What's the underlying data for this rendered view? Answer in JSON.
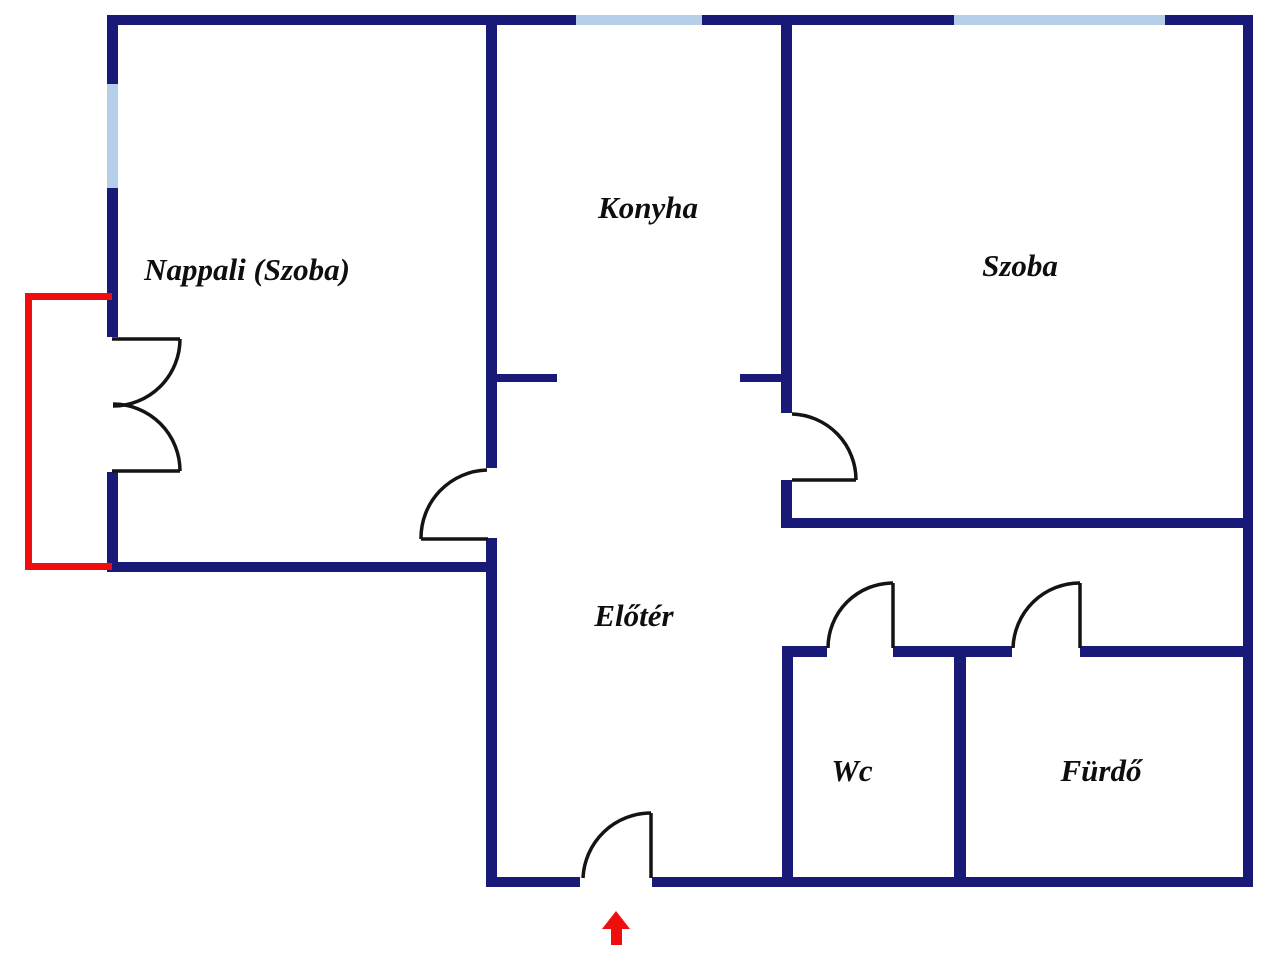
{
  "title": "Apartment floor plan",
  "canvas": {
    "width": 1280,
    "height": 960
  },
  "colors": {
    "wall": "#191977",
    "window": "#b6cfe9",
    "balcony": "#ee0e0e",
    "door": "#141414",
    "arrow": "#ee0e0e",
    "background": "#ffffff",
    "label": "#0e0e0e"
  },
  "rooms": [
    {
      "id": "nappali",
      "label": "Nappali (Szoba)",
      "cx": 247,
      "cy": 270
    },
    {
      "id": "konyha",
      "label": "Konyha",
      "cx": 648,
      "cy": 208
    },
    {
      "id": "szoba",
      "label": "Szoba",
      "cx": 1020,
      "cy": 266
    },
    {
      "id": "eloter",
      "label": "Előtér",
      "cx": 634,
      "cy": 616
    },
    {
      "id": "wc",
      "label": "Wc",
      "cx": 852,
      "cy": 771
    },
    {
      "id": "furdo",
      "label": "Fürdő",
      "cx": 1101,
      "cy": 771
    }
  ],
  "structure": {
    "walls": [
      {
        "name": "top-wall-a",
        "x": 107,
        "y": 15,
        "w": 469,
        "h": 10
      },
      {
        "name": "top-wall-b",
        "x": 702,
        "y": 15,
        "w": 252,
        "h": 10
      },
      {
        "name": "top-wall-c",
        "x": 1165,
        "y": 15,
        "w": 88,
        "h": 10
      },
      {
        "name": "left-wall-a",
        "x": 107,
        "y": 15,
        "w": 11,
        "h": 69
      },
      {
        "name": "left-wall-b",
        "x": 107,
        "y": 188,
        "w": 11,
        "h": 149
      },
      {
        "name": "left-wall-c",
        "x": 107,
        "y": 472,
        "w": 11,
        "h": 94
      },
      {
        "name": "nappali-bottom-wall",
        "x": 107,
        "y": 562,
        "w": 390,
        "h": 10
      },
      {
        "name": "center-wall-a",
        "x": 486,
        "y": 15,
        "w": 11,
        "h": 453
      },
      {
        "name": "center-wall-b",
        "x": 486,
        "y": 538,
        "w": 11,
        "h": 349
      },
      {
        "name": "konyha-stub-left",
        "x": 497,
        "y": 374,
        "w": 60,
        "h": 8
      },
      {
        "name": "konyha-stub-right",
        "x": 740,
        "y": 374,
        "w": 42,
        "h": 8
      },
      {
        "name": "konyha-szoba-wall-a",
        "x": 781,
        "y": 15,
        "w": 11,
        "h": 398
      },
      {
        "name": "konyha-szoba-wall-b",
        "x": 781,
        "y": 480,
        "w": 11,
        "h": 48
      },
      {
        "name": "szoba-bottom-wall",
        "x": 781,
        "y": 518,
        "w": 472,
        "h": 10
      },
      {
        "name": "right-wall",
        "x": 1243,
        "y": 15,
        "w": 10,
        "h": 872
      },
      {
        "name": "bottom-wall-a",
        "x": 486,
        "y": 877,
        "w": 94,
        "h": 10
      },
      {
        "name": "bottom-wall-b",
        "x": 652,
        "y": 877,
        "w": 601,
        "h": 10
      },
      {
        "name": "wc-left-wall",
        "x": 782,
        "y": 646,
        "w": 11,
        "h": 241
      },
      {
        "name": "bath-top-wall-a",
        "x": 782,
        "y": 646,
        "w": 45,
        "h": 11
      },
      {
        "name": "bath-top-wall-b",
        "x": 893,
        "y": 646,
        "w": 119,
        "h": 11
      },
      {
        "name": "bath-top-wall-c",
        "x": 1080,
        "y": 646,
        "w": 173,
        "h": 11
      },
      {
        "name": "wc-furdo-divider",
        "x": 954,
        "y": 657,
        "w": 12,
        "h": 230
      }
    ],
    "windows": [
      {
        "name": "window-konyha-top",
        "x": 576,
        "y": 15,
        "w": 126,
        "h": 10
      },
      {
        "name": "window-szoba-top",
        "x": 954,
        "y": 15,
        "w": 211,
        "h": 10
      },
      {
        "name": "window-nappali-left",
        "x": 107,
        "y": 84,
        "w": 11,
        "h": 104
      }
    ],
    "balcony": [
      {
        "name": "balcony-top",
        "x": 25,
        "y": 293,
        "w": 87,
        "h": 7
      },
      {
        "name": "balcony-left",
        "x": 25,
        "y": 293,
        "w": 7,
        "h": 277
      },
      {
        "name": "balcony-bottom",
        "x": 25,
        "y": 563,
        "w": 87,
        "h": 7
      }
    ],
    "doors": [
      {
        "name": "balcony-door-upper",
        "leaf": [
          112,
          339,
          180,
          339
        ],
        "arc_from": [
          180,
          339
        ],
        "arc_to": [
          113,
          406
        ],
        "r": 67,
        "sweep": 1
      },
      {
        "name": "balcony-door-lower",
        "leaf": [
          112,
          471,
          180,
          471
        ],
        "arc_from": [
          180,
          471
        ],
        "arc_to": [
          113,
          404
        ],
        "r": 67,
        "sweep": 0
      },
      {
        "name": "nappali-door",
        "leaf": [
          421,
          539,
          488,
          539
        ],
        "arc_from": [
          421,
          539
        ],
        "arc_to": [
          487,
          470
        ],
        "r": 68,
        "sweep": 1
      },
      {
        "name": "szoba-door",
        "leaf": [
          792,
          480,
          856,
          480
        ],
        "arc_from": [
          792,
          414
        ],
        "arc_to": [
          856,
          480
        ],
        "r": 66,
        "sweep": 1
      },
      {
        "name": "wc-door",
        "leaf": [
          893,
          583,
          893,
          648
        ],
        "arc_from": [
          893,
          583
        ],
        "arc_to": [
          828,
          648
        ],
        "r": 65,
        "sweep": 0
      },
      {
        "name": "furdo-door",
        "leaf": [
          1080,
          583,
          1080,
          648
        ],
        "arc_from": [
          1080,
          583
        ],
        "arc_to": [
          1013,
          648
        ],
        "r": 67,
        "sweep": 0
      },
      {
        "name": "entrance-door",
        "leaf": [
          651,
          813,
          651,
          878
        ],
        "arc_from": [
          651,
          813
        ],
        "arc_to": [
          583,
          878
        ],
        "r": 68,
        "sweep": 0
      }
    ],
    "entrance_arrow": {
      "head_points": "616,911 602,929 630,929",
      "stem": {
        "x": 611,
        "y": 929,
        "w": 11,
        "h": 16
      }
    }
  }
}
